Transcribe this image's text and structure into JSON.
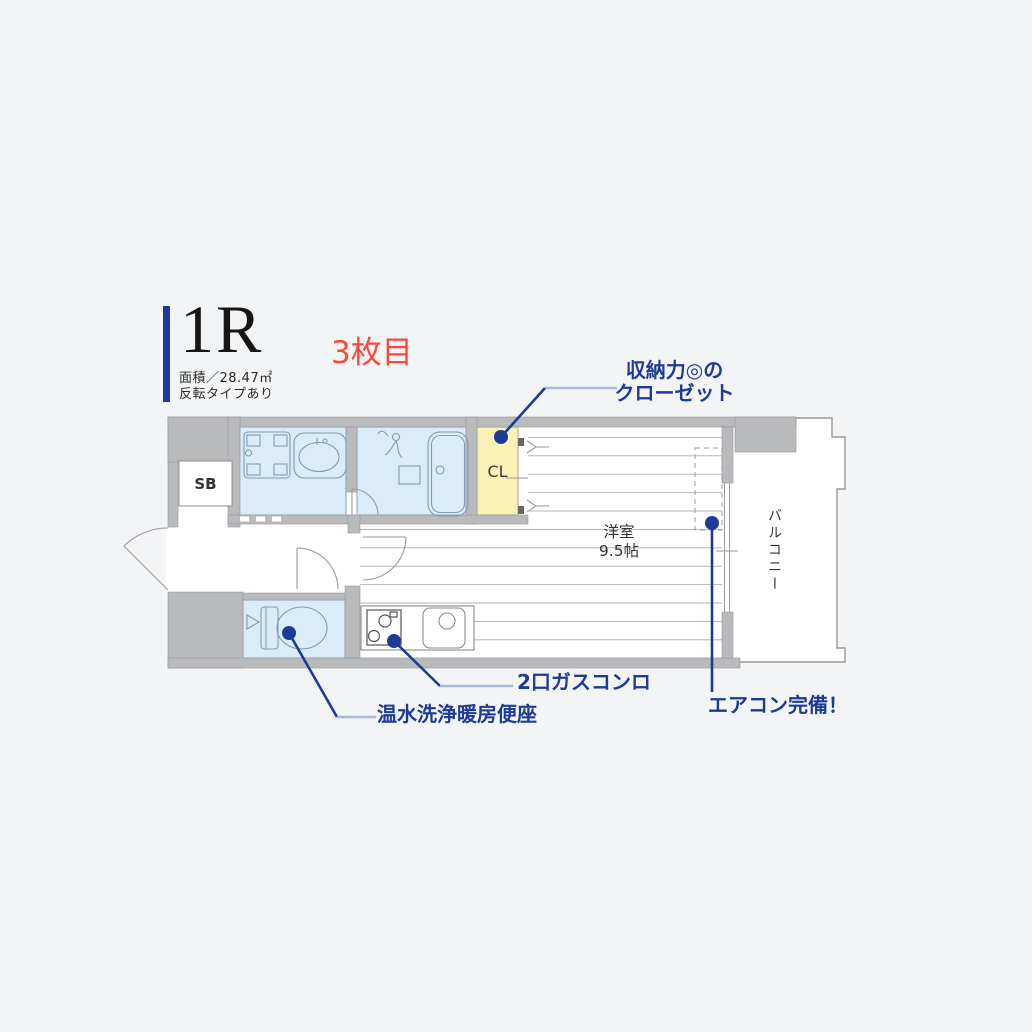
{
  "header": {
    "unit_type": "1R",
    "photo_badge": "3枚目",
    "area_label": "面積／28.47㎡",
    "note_label": "反転タイプあり",
    "accent_color": "#1e3a96",
    "badge_color": "#f94b3c"
  },
  "floorplan": {
    "rooms": {
      "shoe_box": "SB",
      "closet": "CL",
      "main_room_name": "洋室",
      "main_room_size": "9.5帖",
      "balcony": "バルコニー"
    },
    "callouts": [
      {
        "id": "closet",
        "line1": "収納力◎の",
        "line2": "クローゼット"
      },
      {
        "id": "stove",
        "label": "2口ガスコンロ"
      },
      {
        "id": "toilet",
        "label": "温水洗浄暖房便座"
      },
      {
        "id": "aircon",
        "label": "エアコン完備！"
      }
    ],
    "colors": {
      "wall": "#b9babc",
      "wet": "#d9ecf8",
      "closet": "#f8f2b6",
      "floorline": "#b6b6b8",
      "callout": "#1d3b96",
      "leader_light": "#a9b9dc"
    }
  }
}
